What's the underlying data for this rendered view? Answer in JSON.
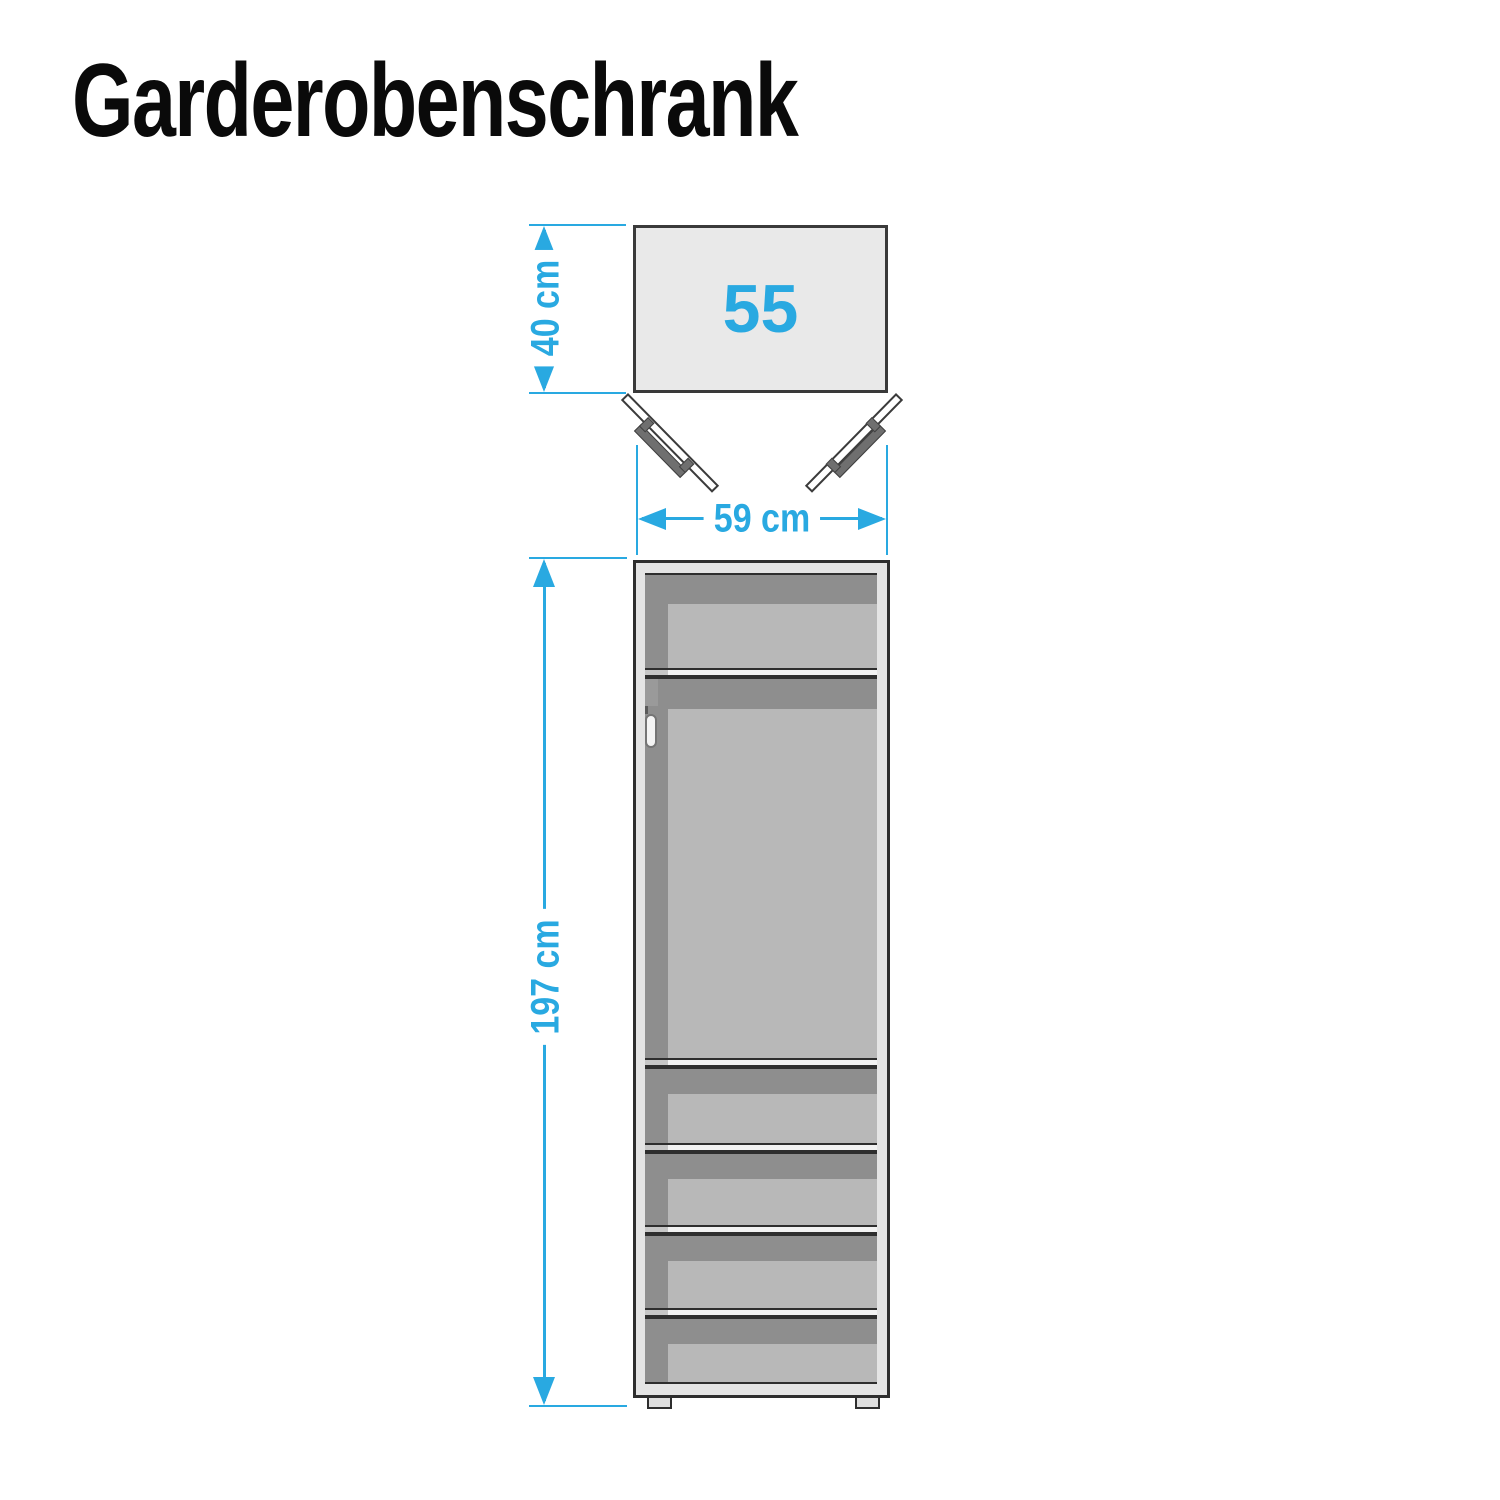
{
  "title": "Garderobenschrank",
  "colors": {
    "accent": "#29a9e1",
    "outline": "#2e2e2e",
    "frame": "#e4e4e4",
    "interior_dark": "#8e8e8e",
    "interior_light": "#b8b8b8",
    "shelf": "#f2f2f2",
    "top_view_fill": "#e9e9e9",
    "handle": "#6f6f6f"
  },
  "top_view": {
    "compartment_label": "55",
    "depth": {
      "value": 40,
      "unit": "cm",
      "label": "40 cm"
    },
    "width": {
      "value": 59,
      "unit": "cm",
      "label": "59 cm"
    },
    "doors": 2
  },
  "front_view": {
    "height": {
      "value": 197,
      "unit": "cm",
      "label": "197 cm"
    },
    "top_compartments": 1,
    "bottom_shelf_compartments": 4,
    "has_hanging_rail": true,
    "feet": 2
  }
}
